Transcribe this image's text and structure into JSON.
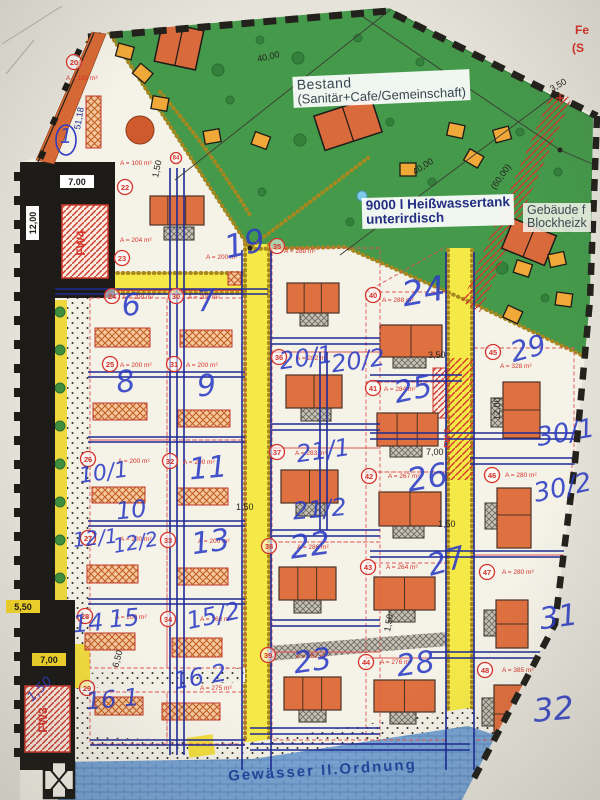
{
  "plan": {
    "labels": {
      "bestand": [
        "Bestand",
        "(Sanitär+Cafe/Gemeinschaft)"
      ],
      "tank": [
        "9000 l Heißwassertank",
        "unterirdisch"
      ],
      "gebaeude": [
        "Gebäude f",
        "Blockheizk"
      ],
      "water": "Gewässer II.Ordnung",
      "edge_note": [
        "Fe",
        "(S"
      ]
    },
    "fw_labels": [
      [
        "FW4",
        85,
        243
      ],
      [
        "FW3",
        47,
        720
      ],
      [
        "FW 6",
        450,
        438
      ]
    ],
    "markers": [
      [
        20,
        74,
        62
      ],
      [
        84,
        176,
        158
      ],
      [
        22,
        125,
        187
      ],
      [
        23,
        122,
        258
      ],
      [
        24,
        112,
        296
      ],
      [
        30,
        176,
        296
      ],
      [
        25,
        110,
        364
      ],
      [
        31,
        174,
        364
      ],
      [
        26,
        88,
        459
      ],
      [
        32,
        170,
        461
      ],
      [
        27,
        88,
        538
      ],
      [
        33,
        168,
        540
      ],
      [
        28,
        85,
        616
      ],
      [
        34,
        168,
        619
      ],
      [
        29,
        87,
        688
      ],
      [
        35,
        277,
        246
      ],
      [
        36,
        279,
        357
      ],
      [
        37,
        277,
        452
      ],
      [
        38,
        269,
        546
      ],
      [
        39,
        268,
        655
      ],
      [
        40,
        373,
        295
      ],
      [
        41,
        373,
        388
      ],
      [
        42,
        369,
        476
      ],
      [
        43,
        368,
        567
      ],
      [
        44,
        366,
        662
      ],
      [
        45,
        493,
        352
      ],
      [
        46,
        492,
        475
      ],
      [
        47,
        487,
        572
      ],
      [
        48,
        485,
        670
      ]
    ],
    "areas": [
      [
        "A = 180 m²",
        66,
        80
      ],
      [
        "A = 100 m²",
        120,
        165
      ],
      [
        "A = 204 m²",
        120,
        242
      ],
      [
        "A = 200 m²",
        206,
        259
      ],
      [
        "A = 200 m²",
        122,
        299
      ],
      [
        "A = 200 m²",
        188,
        299
      ],
      [
        "A = 200 m²",
        120,
        367
      ],
      [
        "A = 200 m²",
        186,
        367
      ],
      [
        "A = 200 m²",
        118,
        463
      ],
      [
        "A = 200 m²",
        183,
        464
      ],
      [
        "A = 200 m²",
        120,
        541
      ],
      [
        "A = 200 m²",
        198,
        543
      ],
      [
        "A = 200 m²",
        115,
        619
      ],
      [
        "A = 168 m²",
        200,
        621
      ],
      [
        "A = 275 m²",
        200,
        690
      ],
      [
        "A = 288 m²",
        284,
        253
      ],
      [
        "A = 282 m²",
        296,
        360
      ],
      [
        "A = 283 m²",
        295,
        455
      ],
      [
        "A = 286 m²",
        297,
        549
      ],
      [
        "A = 282 m²",
        296,
        658
      ],
      [
        "A = 288 m²",
        382,
        302
      ],
      [
        "A = 284 m²",
        384,
        391
      ],
      [
        "A = 267 m²",
        388,
        478
      ],
      [
        "A = 264 m²",
        386,
        569
      ],
      [
        "A = 276 m²",
        380,
        664
      ],
      [
        "A = 328 m²",
        500,
        368
      ],
      [
        "A = 280 m²",
        505,
        477
      ],
      [
        "A = 280 m²",
        502,
        574
      ],
      [
        "A = 385 m²",
        502,
        672
      ]
    ],
    "handwritten": [
      [
        "1",
        66,
        128,
        20,
        0,
        1
      ],
      [
        "6",
        120,
        295,
        30,
        -8
      ],
      [
        "7",
        196,
        290,
        30,
        -5
      ],
      [
        "8",
        114,
        372,
        30,
        -10
      ],
      [
        "9",
        196,
        375,
        30,
        -5
      ],
      [
        "10/1",
        78,
        468,
        22,
        -8
      ],
      [
        "10",
        115,
        502,
        24,
        -6
      ],
      [
        "11",
        188,
        458,
        30,
        -5
      ],
      [
        "12/1",
        72,
        532,
        20,
        -6
      ],
      [
        "12/2",
        112,
        538,
        20,
        -10
      ],
      [
        "13",
        190,
        533,
        30,
        -8
      ],
      [
        "14",
        72,
        615,
        24,
        -5
      ],
      [
        "15",
        108,
        610,
        24,
        -5
      ],
      [
        "15/2",
        185,
        612,
        24,
        -12
      ],
      [
        "16 1",
        85,
        692,
        24,
        -5
      ],
      [
        "16 2",
        172,
        672,
        24,
        -10
      ],
      [
        "19",
        222,
        235,
        32,
        -12
      ],
      [
        "20/1",
        278,
        352,
        24,
        -8
      ],
      [
        "20/2",
        330,
        355,
        24,
        -8
      ],
      [
        "21/1",
        295,
        445,
        24,
        -8
      ],
      [
        "21/2",
        292,
        502,
        24,
        -5
      ],
      [
        "22",
        288,
        535,
        32,
        -8
      ],
      [
        "23",
        292,
        652,
        30,
        -8
      ],
      [
        "24",
        400,
        282,
        34,
        -10
      ],
      [
        "25",
        392,
        382,
        30,
        -12
      ],
      [
        "26",
        405,
        468,
        32,
        -10
      ],
      [
        "27",
        425,
        555,
        30,
        -15
      ],
      [
        "28",
        395,
        655,
        30,
        -8
      ],
      [
        "29",
        508,
        342,
        28,
        -15
      ],
      [
        "30/1",
        535,
        428,
        26,
        -10
      ],
      [
        "30/2",
        532,
        484,
        26,
        -12
      ],
      [
        "31",
        538,
        608,
        30,
        -8
      ],
      [
        "32",
        532,
        698,
        32,
        -5
      ],
      [
        "1,50",
        26,
        696,
        13,
        -45
      ]
    ],
    "dims": [
      [
        "40,00",
        258,
        62,
        -13
      ],
      [
        "40,00",
        415,
        175,
        -33
      ],
      [
        "(60,00)",
        495,
        190,
        -55
      ],
      [
        "3,50",
        552,
        92,
        -30
      ],
      [
        "3,50",
        428,
        358,
        0
      ],
      [
        "1,50",
        236,
        510,
        0
      ],
      [
        "1,50",
        438,
        527,
        0
      ],
      [
        "1,50",
        158,
        178,
        -78
      ],
      [
        "1,50",
        390,
        632,
        -80
      ],
      [
        "7,00",
        426,
        455,
        0
      ],
      [
        "12,00",
        500,
        420,
        -90
      ],
      [
        "51,18",
        80,
        130,
        -80,
        "navy"
      ],
      [
        "6,50",
        118,
        668,
        -75
      ]
    ],
    "boxed_dims": [
      [
        "7.00",
        62,
        185,
        "white",
        0
      ],
      [
        "12,00",
        36,
        238,
        "white",
        -90
      ],
      [
        "5,50",
        8,
        610,
        "yellow",
        0
      ],
      [
        "7,00",
        34,
        663,
        "yellow",
        0
      ]
    ]
  },
  "colors": {
    "marker_red": "#d4332a",
    "area_red": "#d4332a",
    "hand_blue": "#2b3cc4",
    "dim_black": "#26241f",
    "navy": "#1e2a96",
    "fe_red": "#d63127",
    "label_ink": "#3a4650",
    "water_text": "#17378f",
    "green": "#45994b",
    "road_yellow": "#f5e948",
    "building_orange": "#df7040",
    "hut_orange": "#f0a838"
  }
}
